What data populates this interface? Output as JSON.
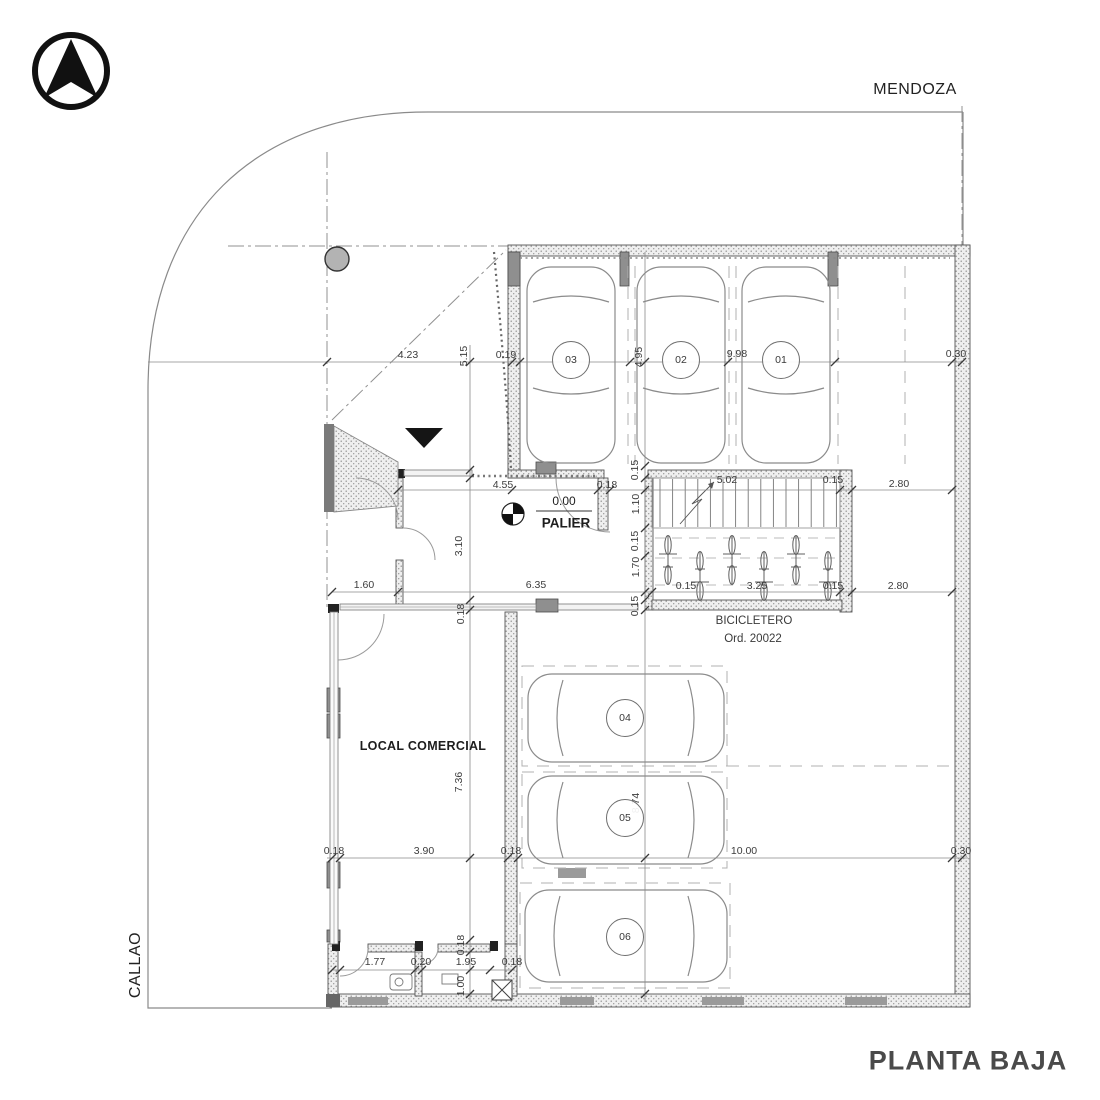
{
  "plan": {
    "title": "PLANTA BAJA",
    "streets": {
      "top": "MENDOZA",
      "left": "CALLAO"
    },
    "rooms": {
      "palier_level": "0.00",
      "palier": "PALIER",
      "local": "LOCAL COMERCIAL",
      "bicicletero": "BICICLETERO",
      "bicicletero_ord": "Ord. 20022"
    },
    "parking_spots": [
      {
        "id": "03",
        "x": 571,
        "y": 360
      },
      {
        "id": "02",
        "x": 681,
        "y": 360
      },
      {
        "id": "01",
        "x": 781,
        "y": 360
      },
      {
        "id": "04",
        "x": 625,
        "y": 718
      },
      {
        "id": "05",
        "x": 625,
        "y": 818
      },
      {
        "id": "06",
        "x": 625,
        "y": 937
      }
    ],
    "dimension_labels": [
      {
        "v": "4.23",
        "x": 408,
        "y": 355,
        "rot": 0
      },
      {
        "v": "5.15",
        "x": 464,
        "y": 356,
        "rot": 1
      },
      {
        "v": "0.19",
        "x": 506,
        "y": 355,
        "rot": 0
      },
      {
        "v": "4.95",
        "x": 639,
        "y": 357,
        "rot": 1
      },
      {
        "v": "9.98",
        "x": 737,
        "y": 354,
        "rot": 0
      },
      {
        "v": "0.30",
        "x": 956,
        "y": 354,
        "rot": 0
      },
      {
        "v": "4.55",
        "x": 503,
        "y": 485,
        "rot": 0
      },
      {
        "v": "0.18",
        "x": 607,
        "y": 485,
        "rot": 0
      },
      {
        "v": "5.02",
        "x": 727,
        "y": 480,
        "rot": 0
      },
      {
        "v": "0.15",
        "x": 833,
        "y": 480,
        "rot": 0
      },
      {
        "v": "2.80",
        "x": 899,
        "y": 484,
        "rot": 0
      },
      {
        "v": "0.15",
        "x": 635,
        "y": 470,
        "rot": 1
      },
      {
        "v": "1.10",
        "x": 636,
        "y": 504,
        "rot": 1
      },
      {
        "v": "0.15",
        "x": 635,
        "y": 541,
        "rot": 1
      },
      {
        "v": "1.70",
        "x": 636,
        "y": 567,
        "rot": 1
      },
      {
        "v": "0.15",
        "x": 635,
        "y": 606,
        "rot": 1
      },
      {
        "v": "3.10",
        "x": 459,
        "y": 546,
        "rot": 1
      },
      {
        "v": "0.18",
        "x": 461,
        "y": 614,
        "rot": 1
      },
      {
        "v": "1.60",
        "x": 364,
        "y": 585,
        "rot": 0
      },
      {
        "v": "6.35",
        "x": 536,
        "y": 585,
        "rot": 0
      },
      {
        "v": "0.15",
        "x": 686,
        "y": 586,
        "rot": 0
      },
      {
        "v": "3.25",
        "x": 757,
        "y": 586,
        "rot": 0
      },
      {
        "v": "0.15",
        "x": 833,
        "y": 586,
        "rot": 0
      },
      {
        "v": "2.80",
        "x": 898,
        "y": 586,
        "rot": 0
      },
      {
        "v": "7.36",
        "x": 459,
        "y": 782,
        "rot": 1
      },
      {
        "v": "8.74",
        "x": 636,
        "y": 803,
        "rot": 1
      },
      {
        "v": "0.18",
        "x": 334,
        "y": 851,
        "rot": 0
      },
      {
        "v": "3.90",
        "x": 424,
        "y": 851,
        "rot": 0
      },
      {
        "v": "0.18",
        "x": 511,
        "y": 851,
        "rot": 0
      },
      {
        "v": "10.00",
        "x": 744,
        "y": 851,
        "rot": 0
      },
      {
        "v": "0.30",
        "x": 961,
        "y": 851,
        "rot": 0
      },
      {
        "v": "0.18",
        "x": 461,
        "y": 945,
        "rot": 1
      },
      {
        "v": "1.00",
        "x": 461,
        "y": 986,
        "rot": 1
      },
      {
        "v": "1.77",
        "x": 375,
        "y": 962,
        "rot": 0
      },
      {
        "v": "0.20",
        "x": 421,
        "y": 962,
        "rot": 0
      },
      {
        "v": "1.95",
        "x": 466,
        "y": 962,
        "rot": 0
      },
      {
        "v": "0.18",
        "x": 512,
        "y": 962,
        "rot": 0
      }
    ],
    "colors": {
      "linework": "#555555",
      "dim_text": "#3c3c3c",
      "wall_dark": "#8f8f8f",
      "title_text": "#4a4a4a"
    }
  }
}
